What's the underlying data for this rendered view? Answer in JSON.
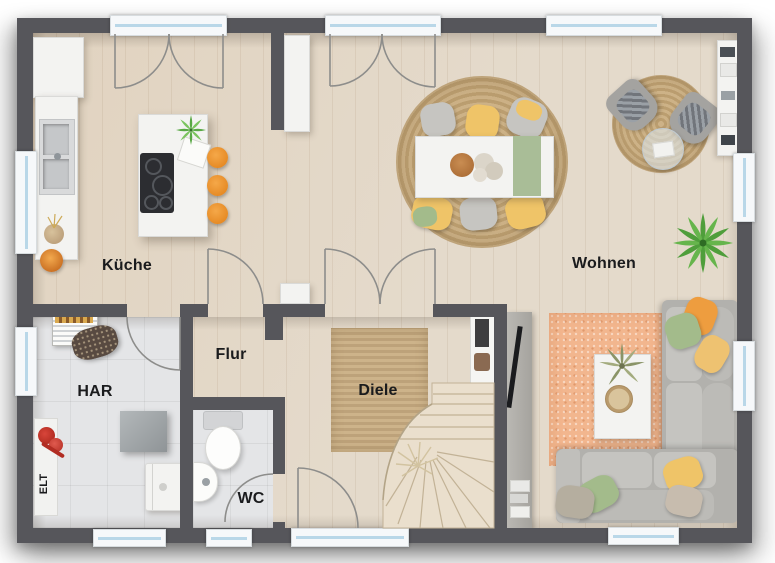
{
  "plan": {
    "title": "Erdgeschoss Grundriss",
    "rooms": {
      "kueche": {
        "label": "Küche"
      },
      "wohnen": {
        "label": "Wohnen"
      },
      "flur": {
        "label": "Flur"
      },
      "diele": {
        "label": "Diele"
      },
      "har": {
        "label": "HAR"
      },
      "wc": {
        "label": "WC"
      },
      "elt": {
        "label": "ELT"
      }
    },
    "colors": {
      "wall": "#56565b",
      "wood_floor": "#e4dacb",
      "tile_floor": "#e4e5e7",
      "rug_jute": "#c8ad83",
      "rug_orange": "#f2b68e",
      "sofa_grey": "#b4b3af",
      "accent_orange": "#ee9d3f",
      "accent_yellow": "#efc468",
      "accent_green": "#a3bb8b",
      "window_glass": "#b9d7e8"
    },
    "features": {
      "doors": [
        "kitchen-terrace-double-door",
        "dining-terrace-double-door",
        "diele-wohnen-double-door",
        "kueche-flur-door",
        "har-door",
        "wc-door",
        "entry-door"
      ],
      "windows": [
        "top-right-window",
        "kitchen-left-window",
        "har-left-window",
        "wohnen-right-window-1",
        "wohnen-right-window-2",
        "har-bottom-window",
        "wc-bottom-window",
        "living-bottom-window"
      ]
    }
  }
}
